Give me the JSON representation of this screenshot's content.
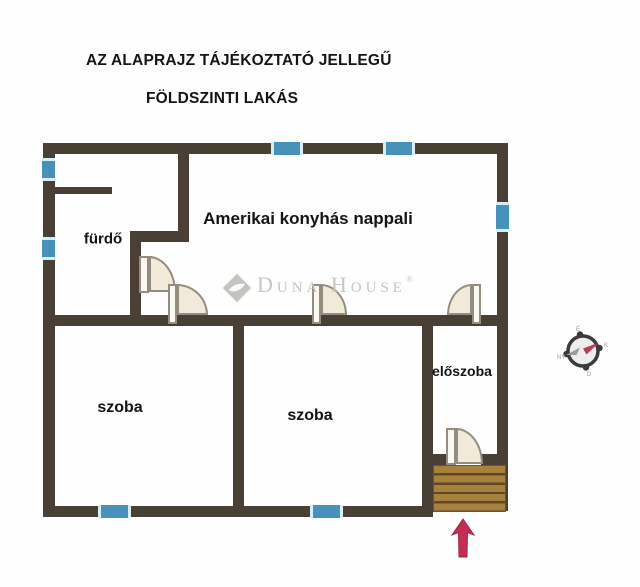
{
  "header": {
    "line1": "AZ ALAPRAJZ TÁJÉKOZTATÓ JELLEGŰ",
    "line2": "FÖLDSZINTI LAKÁS"
  },
  "rooms": {
    "bathroom": "fürdő",
    "living": "Amerikai konyhás nappali",
    "room1": "szoba",
    "room2": "szoba",
    "hall": "előszoba"
  },
  "watermark": {
    "brand": "Duna House",
    "registered": "®"
  },
  "compass": {
    "north": "É",
    "east": "K",
    "south": "D",
    "west": "NY"
  },
  "colors": {
    "wall": "#4a3f35",
    "window": "#4792ba",
    "door_fill": "#f2ead9",
    "stairs_wood": "#a8813f",
    "entrance_arrow": "#c22f52",
    "watermark_gray": "#c7c5c0"
  }
}
